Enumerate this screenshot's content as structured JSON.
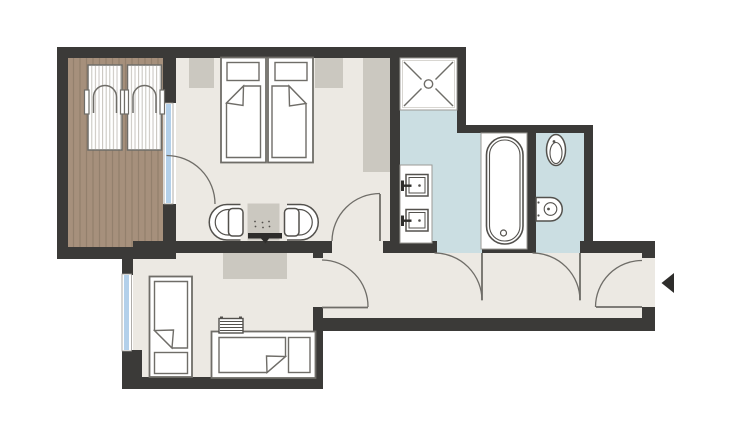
{
  "palette": {
    "background": "#ffffff",
    "wall": "#3b3a38",
    "floor": "#ece9e3",
    "wet_floor": "#cbdee2",
    "glass": "#b3d0ea",
    "deck": "#a6907c",
    "deck_stripe": "#93806d",
    "accent": "#cbc8c0",
    "fixture_line": "#53514d",
    "furniture_line": "#6f6d68",
    "soft_line": "#9b9995",
    "stripe_light": "#c6c3bd",
    "black": "#2e2d2b"
  },
  "plan": {
    "type": "apartment-floor-plan",
    "rooms": [
      {
        "id": "balcony",
        "floor": "wood-deck",
        "fixtures": [
          "sun-lounger",
          "sun-lounger"
        ]
      },
      {
        "id": "bedroom",
        "floor": "light",
        "fixtures": [
          "twin-bed-left",
          "twin-bed-right",
          "nightstand-left",
          "nightstand-right",
          "wardrobe",
          "armchair-left",
          "armchair-right",
          "side-table",
          "tv"
        ]
      },
      {
        "id": "bathroom",
        "floor": "tile-blue",
        "fixtures": [
          "shower",
          "vanity-counter",
          "sink-upper",
          "sink-lower",
          "bathtub"
        ]
      },
      {
        "id": "wc",
        "floor": "tile-blue",
        "fixtures": [
          "toilet",
          "bidet"
        ]
      },
      {
        "id": "hallway",
        "floor": "light",
        "fixtures": [
          "entrance-door"
        ]
      },
      {
        "id": "second-room",
        "floor": "light",
        "fixtures": [
          "single-bed-vertical",
          "single-bed-horizontal",
          "radiator",
          "rug"
        ]
      }
    ],
    "doors": 6,
    "windows": 2,
    "entry_arrow_direction": "left"
  }
}
